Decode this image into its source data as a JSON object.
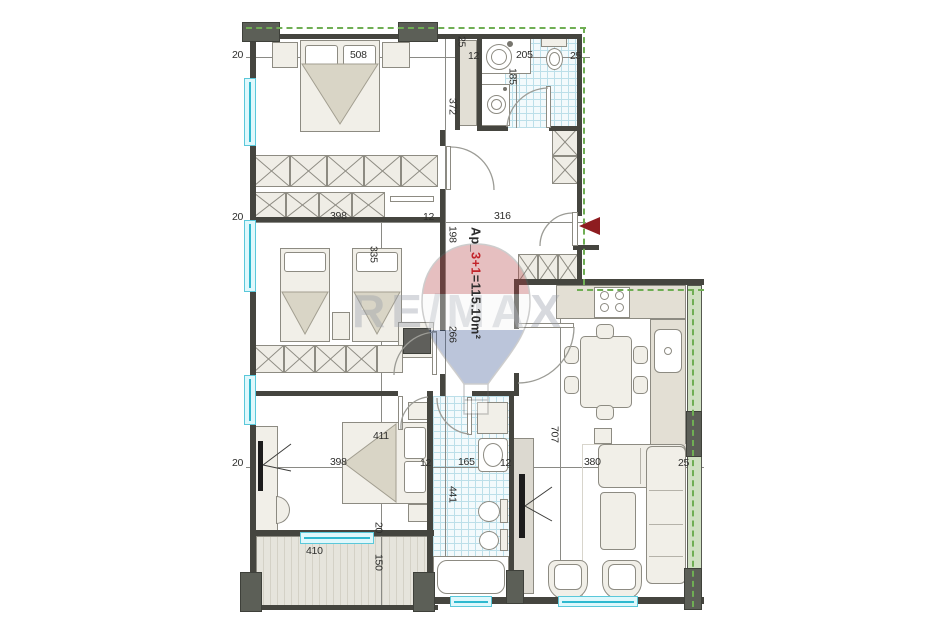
{
  "plan": {
    "type_label": "apartment floor plan",
    "apartment": {
      "prefix": "Ap_",
      "highlight": "3+1",
      "suffix": "=115.10m²"
    },
    "watermark": {
      "text": "RE/MAX"
    },
    "colors": {
      "boundary_dash_green": "#6fae54",
      "window_cyan": "#2fb9cf",
      "entrance_arrow_red": "#8e1c20",
      "apartment_highlight_red": "#c2232a",
      "wall_dark": "#45453f",
      "tile_blue": "#bcdfe9"
    },
    "dims": {
      "t20": "20",
      "t508": "508",
      "t12": "12",
      "t205": "205",
      "t25": "25",
      "t25w": "25",
      "v185": "185",
      "v372": "372",
      "m20": "20",
      "m398": "398",
      "m12": "12",
      "m316": "316",
      "v198": "198",
      "v335": "335",
      "v266": "266",
      "b411": "411",
      "l20": "20",
      "l398": "398",
      "l12a": "12",
      "l165": "165",
      "l12b": "12",
      "l380": "380",
      "l25": "25",
      "v441": "441",
      "v707": "707",
      "v20": "20",
      "v150": "150",
      "bal410": "410"
    }
  }
}
